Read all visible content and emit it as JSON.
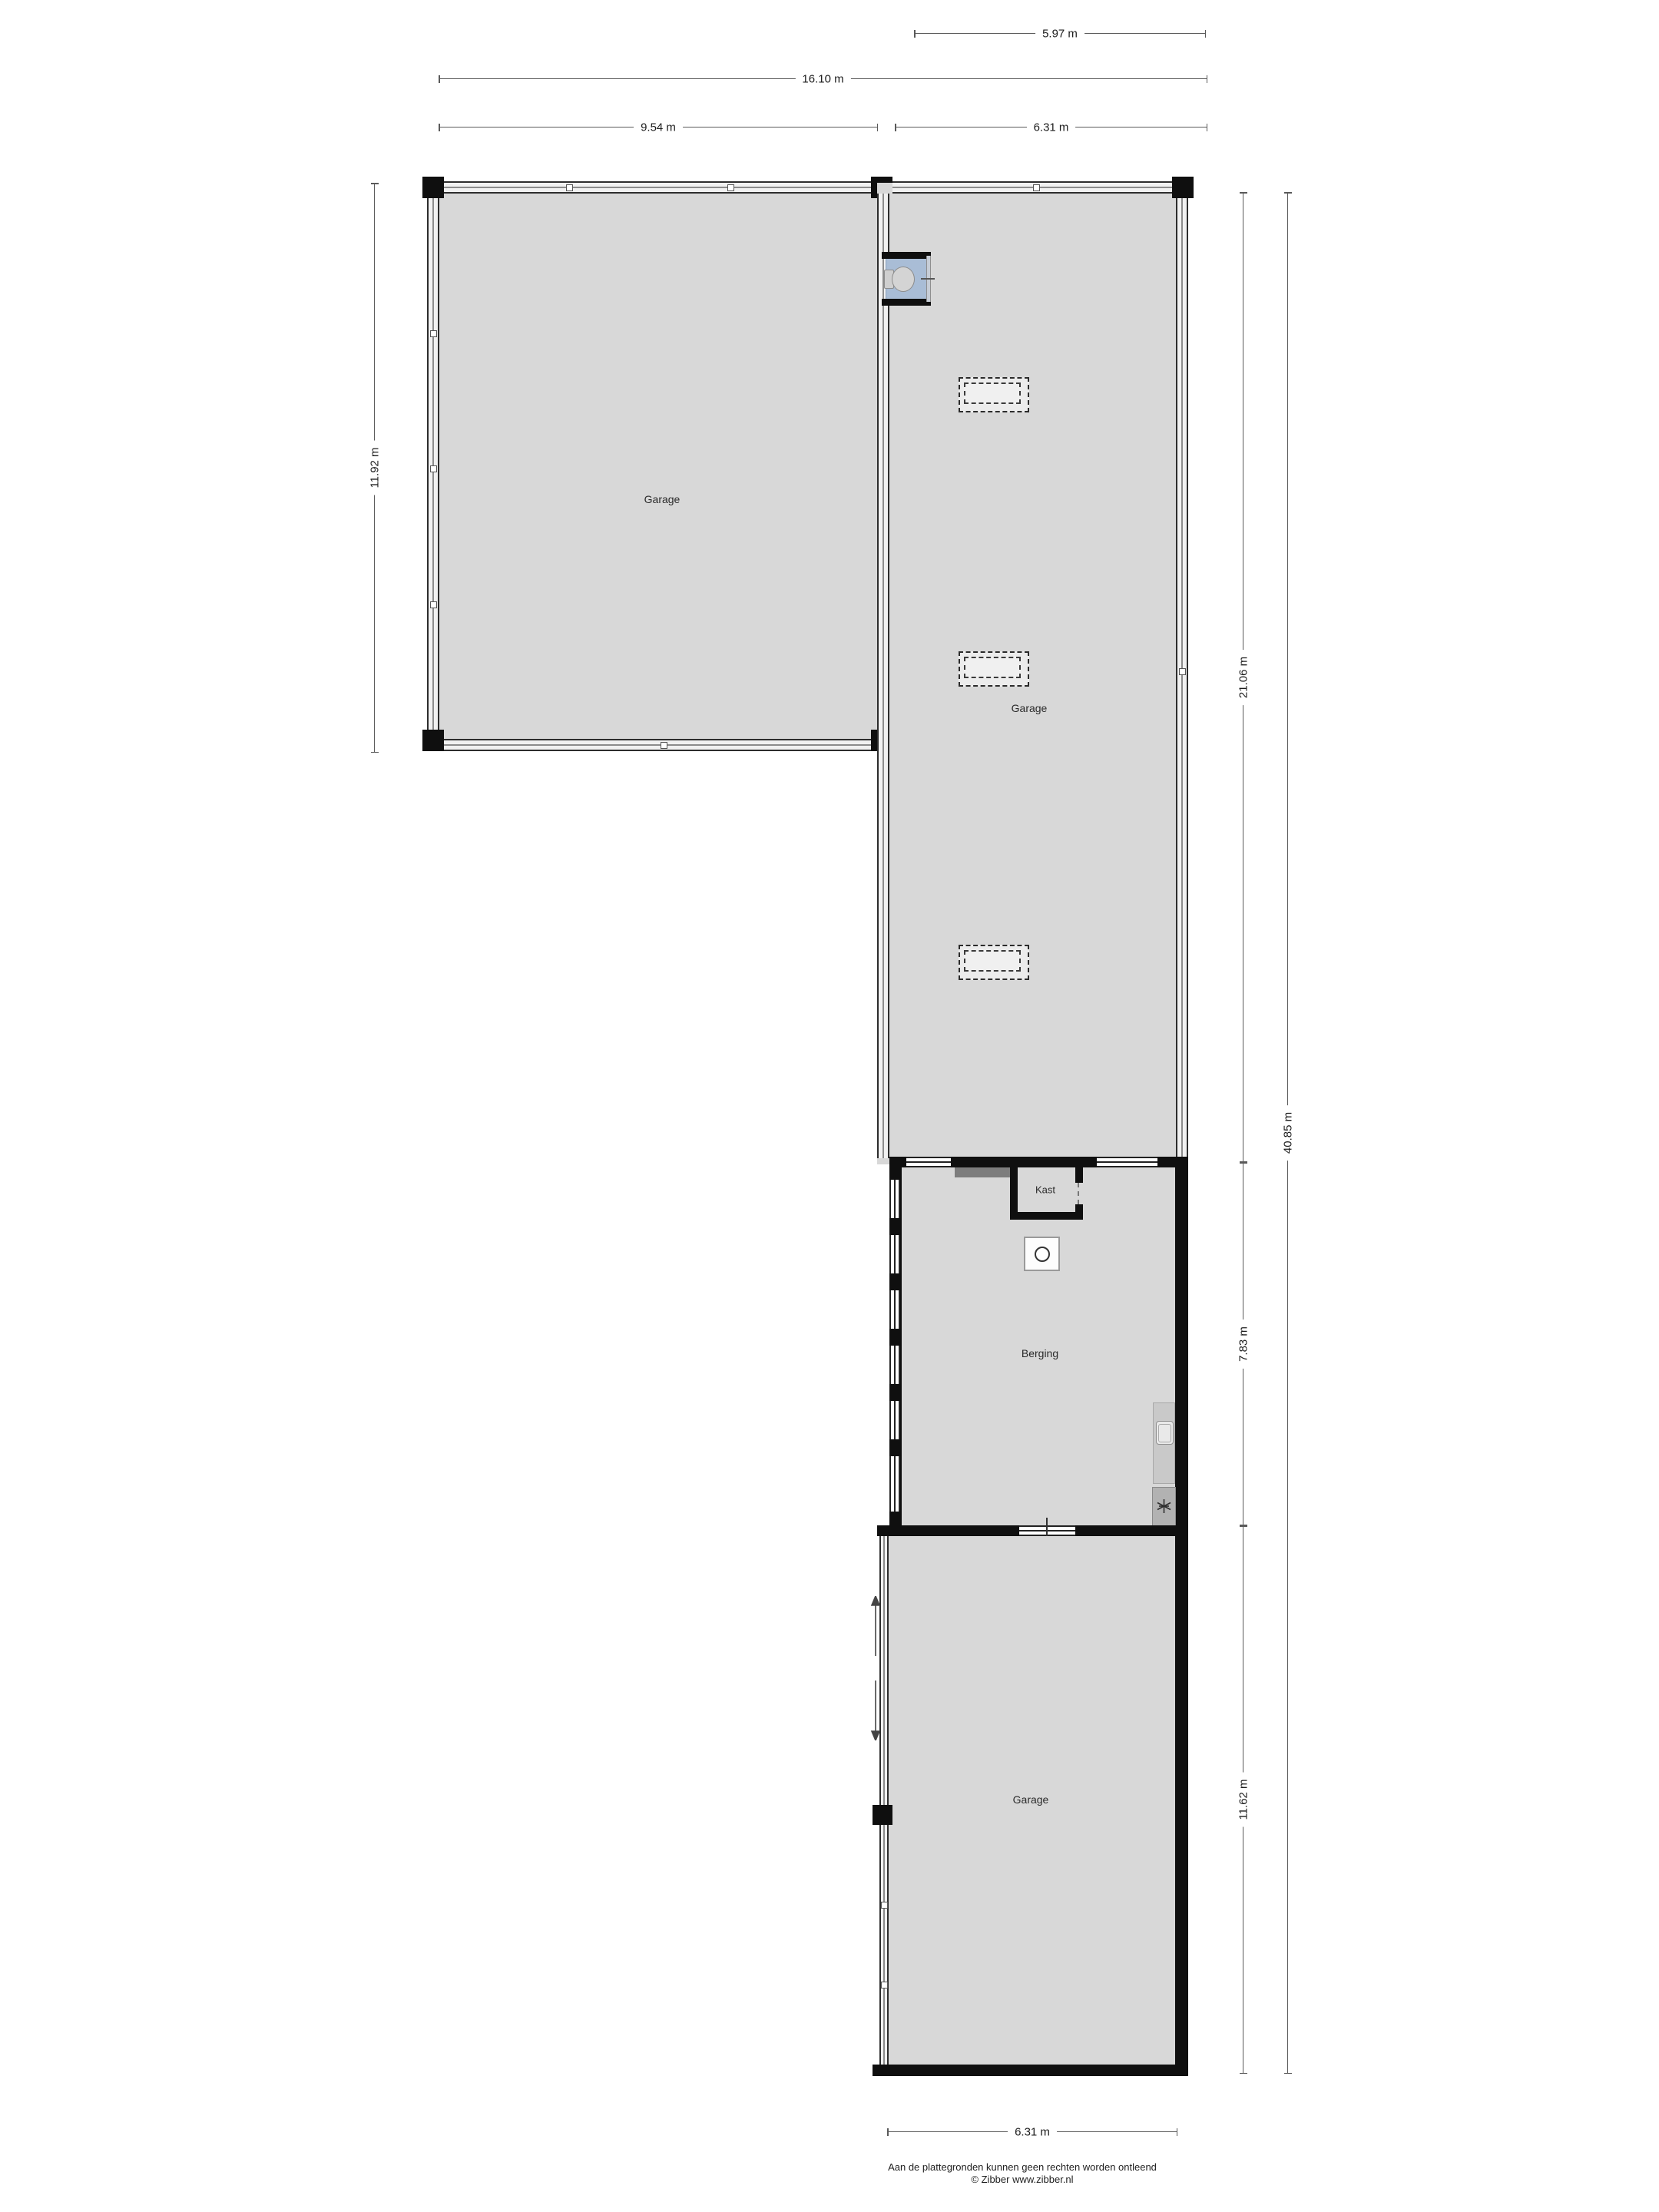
{
  "plan": {
    "type": "floor plan",
    "source_style": "Zibber"
  },
  "dims": {
    "top_597": "5.97 m",
    "top_1610": "16.10 m",
    "top_954": "9.54 m",
    "top_631": "6.31 m",
    "left_1192": "11.92 m",
    "right_2106": "21.06 m",
    "right_4085": "40.85 m",
    "right_783": "7.83 m",
    "right_1162": "11.62 m",
    "bottom_631": "6.31 m"
  },
  "rooms": {
    "garage_left": "Garage",
    "garage_middle": "Garage",
    "kast": "Kast",
    "berging": "Berging",
    "garage_bottom": "Garage"
  },
  "footer": {
    "disclaimer": "Aan de plattegronden kunnen geen rechten worden ontleend",
    "copyright": "© Zibber www.zibber.nl"
  },
  "colors": {
    "floor": "#d8d8d8",
    "wall": "#0f0f0f",
    "toilet_floor": "#a9bdd6",
    "dimension_line": "#5a5a5a"
  },
  "icons": {
    "toilet": "toilet-icon",
    "boiler": "boiler-circle-icon",
    "fridge": "snowflake-icon",
    "sliding_door": "double-arrow-icon",
    "skylight": "dashed-skylight"
  }
}
